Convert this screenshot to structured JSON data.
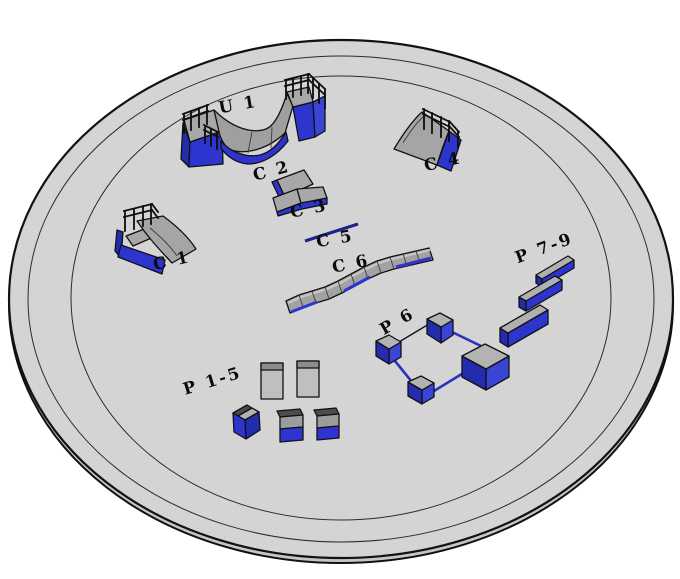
{
  "scene": {
    "kind": "3D rendered skatepark equipment layout on a circular concrete pad",
    "view": "isometric perspective",
    "background_color": "#ffffff",
    "pad_color": "#d7d7d7",
    "outline_color": "#111111",
    "accent_blue": "#2e35cf",
    "accent_blue_dark": "#232bae",
    "accent_blue_light": "#3a45d6",
    "surface_gray": "#a8a8a8",
    "surface_gray_light": "#bfbfbf",
    "rail_navy": "#1c2390"
  },
  "obstacles": [
    {
      "id": "u1",
      "label": "U 1",
      "kind": "halfpipe mini ramp with platform railings"
    },
    {
      "id": "c1",
      "label": "C 1",
      "kind": "quarter pipe ramp with railing"
    },
    {
      "id": "c2",
      "label": "C 2",
      "kind": "bank panel"
    },
    {
      "id": "c3",
      "label": "C 3",
      "kind": "bank panel pair"
    },
    {
      "id": "c4",
      "label": "C 4",
      "kind": "quarter pipe ramp with railing"
    },
    {
      "id": "c5",
      "label": "C 5",
      "kind": "flat grind rail"
    },
    {
      "id": "c6",
      "label": "C 6",
      "kind": "long segmented wave ledge"
    },
    {
      "id": "p15",
      "label": "P 1-5",
      "kind": "blocks and manual pads"
    },
    {
      "id": "p6",
      "label": "P 6",
      "kind": "cube and rail combo"
    },
    {
      "id": "p79",
      "label": "P 7-9",
      "kind": "three grind ledges"
    }
  ]
}
